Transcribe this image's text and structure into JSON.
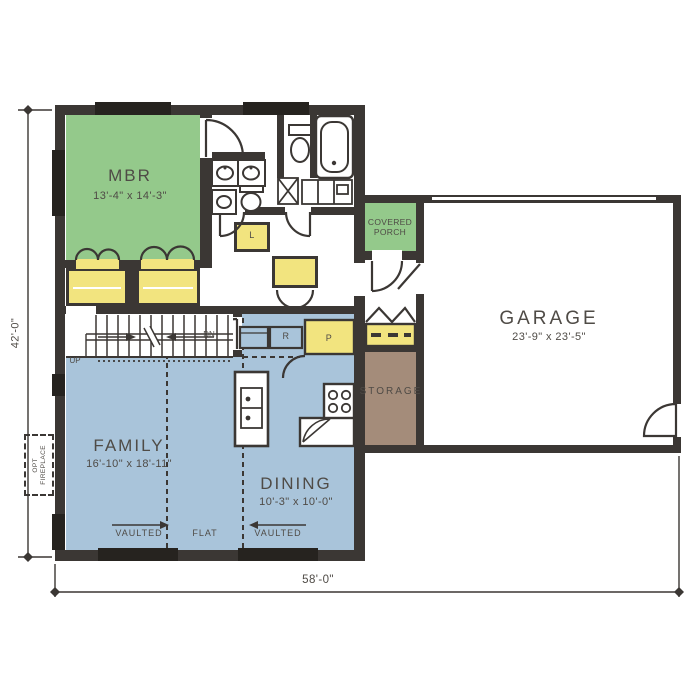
{
  "rooms": {
    "mbr": {
      "name": "MBR",
      "dims": "13'-4\" x 14'-3\""
    },
    "family": {
      "name": "FAMILY",
      "dims": "16'-10\" x 18'-11\""
    },
    "dining": {
      "name": "DINING",
      "dims": "10'-3\" x 10'-0\""
    },
    "garage": {
      "name": "GARAGE",
      "dims": "23'-9\" x 23'-5\""
    },
    "porch": {
      "line1": "COVERED",
      "line2": "PORCH"
    },
    "storage": {
      "name": "STORAGE"
    }
  },
  "labels": {
    "up": "UP",
    "dn": "DN",
    "linen": "L",
    "refrigerator": "R",
    "pantry": "P",
    "fireplace_line1": "OPT",
    "fireplace_line2": "FIREPLACE",
    "ceiling_left": "VAULTED",
    "ceiling_mid": "FLAT",
    "ceiling_right": "VAULTED"
  },
  "dimensions": {
    "overall_width": "58'-0\"",
    "overall_height": "42'-0\""
  },
  "colors": {
    "bedroom_green": "#94c98b",
    "living_blue": "#a9c4da",
    "closet_yellow": "#f2e47f",
    "storage_brown": "#a48c7a",
    "wall_dark": "#3b3734",
    "text_gray": "#4f4b46"
  }
}
